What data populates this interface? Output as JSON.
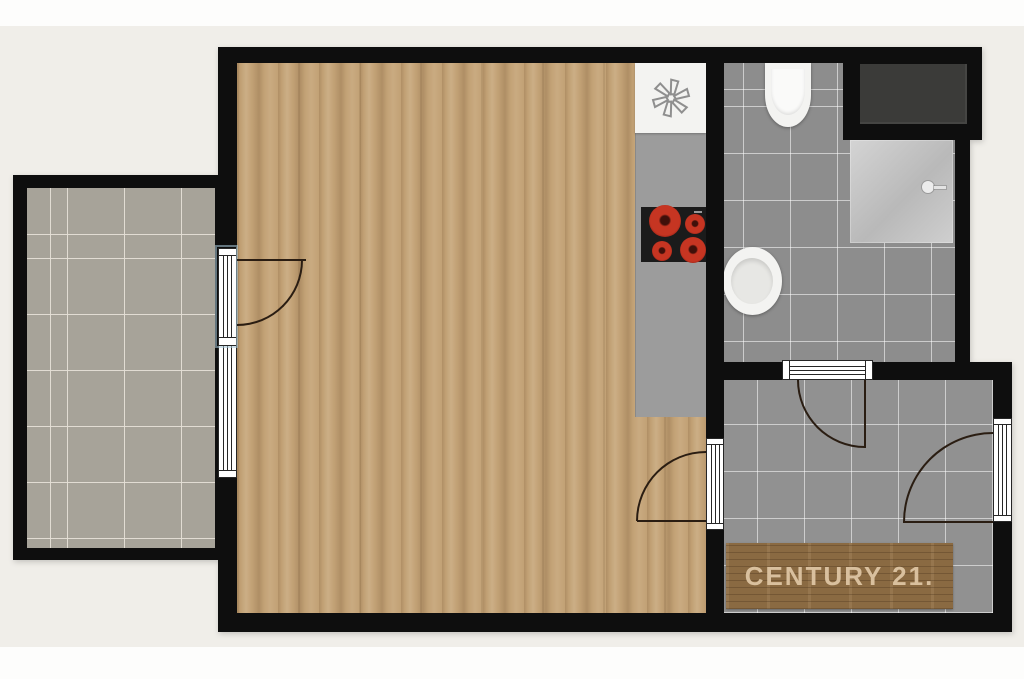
{
  "watermark": {
    "brand": "CENTURY 21."
  },
  "colors": {
    "page": "#fdfdfc",
    "background": "#f0eee9",
    "wall": "#0e0e0e",
    "wood_floor": "#c2a175",
    "balcony_tile": "#a7a399",
    "bath_tile": "#8d8d8d",
    "hall_tile": "#919191",
    "counter": "#9c9c9c",
    "stove": "#1b1b1b",
    "burner_red": "#c63522",
    "fixture_white": "#f3f3f1",
    "shower_glass": "#b9b9b9",
    "closet_dark": "#3b3b39",
    "mat_wood": "#8a6a42",
    "mat_text": "#d9c09e",
    "door_arc": "#2a1d12",
    "window_tint": "#a9cadb"
  },
  "icons": {
    "sink_drain": "six-petal-pinwheel",
    "shower_head": "circle-with-wall-arm",
    "stove_burners": "four-red-rings"
  }
}
